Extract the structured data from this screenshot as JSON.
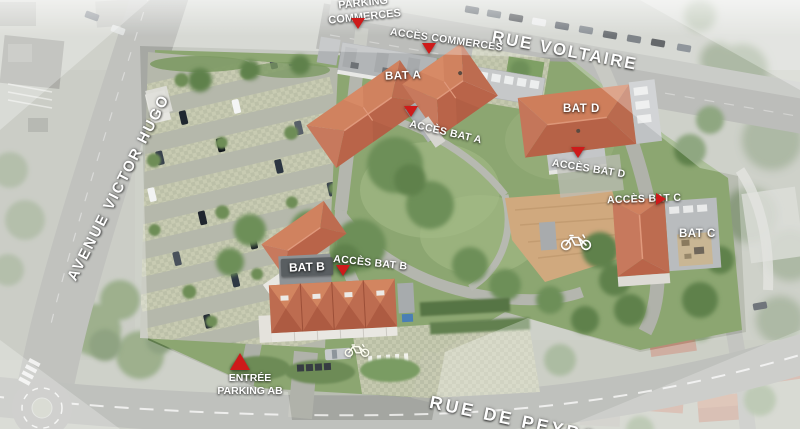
{
  "title": "Plan de masse aérien de la résidence",
  "streets": [
    {
      "id": "rue-voltaire",
      "label": "RUE VOLTAIRE"
    },
    {
      "id": "avenue-victor-hugo",
      "label": "AVENUE VICTOR HUGO"
    },
    {
      "id": "rue-de-peyro",
      "label": "RUE DE PEYRO"
    }
  ],
  "buildings": [
    {
      "id": "bat-a",
      "label": "BAT A"
    },
    {
      "id": "bat-b",
      "label": "BAT B"
    },
    {
      "id": "bat-c",
      "label": "BAT C"
    },
    {
      "id": "bat-d",
      "label": "BAT D"
    }
  ],
  "access_points": [
    {
      "id": "parking-commerces",
      "line1": "PARKING",
      "line2": "COMMERCES",
      "marker": "triangle-down"
    },
    {
      "id": "acces-commerces",
      "label": "ACCÈS COMMERCES",
      "marker": "triangle-down"
    },
    {
      "id": "acces-bat-a",
      "label": "ACCÈS BAT A",
      "marker": "triangle-down"
    },
    {
      "id": "acces-bat-b",
      "label": "ACCÈS BAT B",
      "marker": "triangle-down"
    },
    {
      "id": "acces-bat-c",
      "label": "ACCÈS BAT C",
      "marker": "triangle-right"
    },
    {
      "id": "acces-bat-d",
      "label": "ACCÈS BAT D",
      "marker": "triangle-down"
    },
    {
      "id": "entree-parking-ab",
      "line1": "ENTRÉE",
      "line2": "PARKING AB",
      "marker": "triangle-up"
    }
  ],
  "icons": [
    {
      "id": "bike-east",
      "name": "bicycle-icon"
    },
    {
      "id": "bike-south",
      "name": "bicycle-icon"
    }
  ],
  "colors": {
    "marker_red": "#ce1a1a",
    "roof_orange": "#c4765a",
    "site_green": "#8ca671",
    "road_gray": "#a4a6a1",
    "dirt_tan": "#d0a97e",
    "label_white": "#ffffff"
  }
}
